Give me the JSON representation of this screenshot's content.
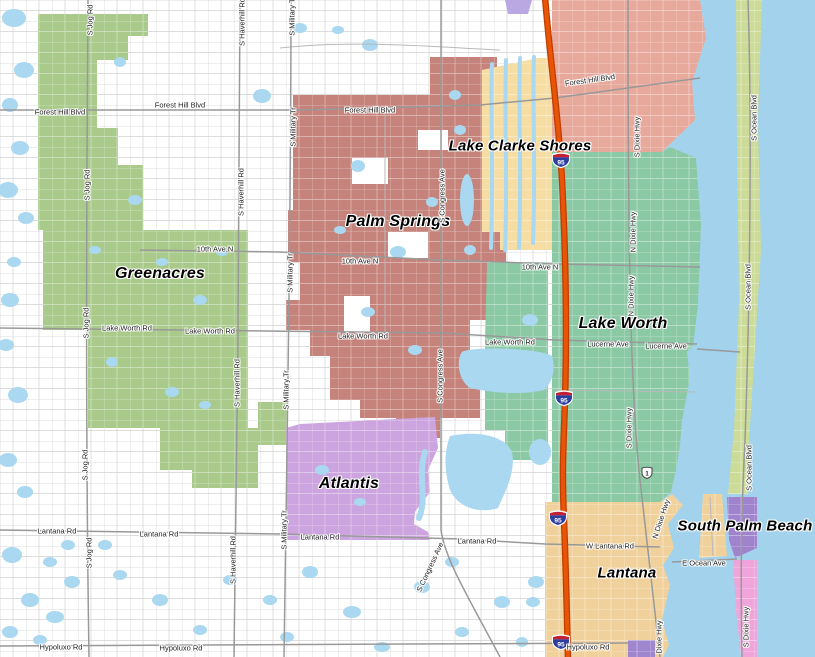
{
  "map": {
    "title": "Palm Beach County municipalities map",
    "regions": {
      "greenacres": {
        "name": "Greenacres",
        "color": "#a9ca8b"
      },
      "palm_springs": {
        "name": "Palm Springs",
        "color": "#c5837b"
      },
      "lake_clarke_shores": {
        "name": "Lake Clarke Shores",
        "color": "#f6dda4"
      },
      "north_pink_area": {
        "color": "#e7a99c"
      },
      "lake_worth": {
        "name": "Lake Worth",
        "color": "#8bc9a5"
      },
      "atlantis": {
        "name": "Atlantis",
        "color": "#cca4df"
      },
      "lantana": {
        "name": "Lantana",
        "color": "#f0d19c"
      },
      "south_palm_beach": {
        "name": "South Palm Beach",
        "color": "#a083cd"
      },
      "barrier_island": {
        "color": "#ccdb97"
      },
      "south_pink_area": {
        "color": "#f0a5da"
      },
      "south_purple_area": {
        "color": "#9f86cf"
      },
      "top_purple_area": {
        "color": "#b9a8e2"
      }
    },
    "water": {
      "ocean_color": "#a2d2ec",
      "pond_color": "#a9d8f0"
    },
    "roads": {
      "major_color": "#999999",
      "minor_color": "#b9b9b9",
      "interstate_color": "#e85507"
    },
    "city_labels": [
      {
        "text": "Lake Clarke Shores",
        "x": 520,
        "y": 146,
        "size": 15
      },
      {
        "text": "Palm Springs",
        "x": 398,
        "y": 222,
        "size": 16
      },
      {
        "text": "Greenacres",
        "x": 160,
        "y": 274,
        "size": 16
      },
      {
        "text": "Lake Worth",
        "x": 623,
        "y": 324,
        "size": 16
      },
      {
        "text": "Atlantis",
        "x": 349,
        "y": 484,
        "size": 16
      },
      {
        "text": "South Palm Beach",
        "x": 745,
        "y": 526,
        "size": 15
      },
      {
        "text": "Lantana",
        "x": 627,
        "y": 573,
        "size": 15
      }
    ],
    "road_labels": [
      {
        "text": "Forest Hill Blvd",
        "x": 60,
        "y": 112,
        "angle": 0
      },
      {
        "text": "Forest Hill Blvd",
        "x": 180,
        "y": 105,
        "angle": 0
      },
      {
        "text": "Forest Hill Blvd",
        "x": 370,
        "y": 110,
        "angle": 0
      },
      {
        "text": "Forest Hill Blvd",
        "x": 590,
        "y": 80,
        "angle": -8
      },
      {
        "text": "10th Ave N",
        "x": 215,
        "y": 249,
        "angle": 0
      },
      {
        "text": "10th Ave N",
        "x": 360,
        "y": 261,
        "angle": 0
      },
      {
        "text": "10th Ave N",
        "x": 540,
        "y": 267,
        "angle": 0
      },
      {
        "text": "Lake Worth Rd",
        "x": 127,
        "y": 328,
        "angle": 0
      },
      {
        "text": "Lake Worth Rd",
        "x": 210,
        "y": 331,
        "angle": 0
      },
      {
        "text": "Lake Worth Rd",
        "x": 363,
        "y": 336,
        "angle": 0
      },
      {
        "text": "Lake Worth Rd",
        "x": 510,
        "y": 342,
        "angle": 0
      },
      {
        "text": "Lucerne Ave",
        "x": 608,
        "y": 344,
        "angle": 0
      },
      {
        "text": "Lucerne Ave",
        "x": 666,
        "y": 346,
        "angle": 0
      },
      {
        "text": "Lantana Rd",
        "x": 57,
        "y": 531,
        "angle": 0
      },
      {
        "text": "Lantana Rd",
        "x": 159,
        "y": 534,
        "angle": 0
      },
      {
        "text": "Lantana Rd",
        "x": 320,
        "y": 537,
        "angle": 0
      },
      {
        "text": "Lantana Rd",
        "x": 477,
        "y": 541,
        "angle": 0
      },
      {
        "text": "W Lantana Rd",
        "x": 610,
        "y": 546,
        "angle": 0
      },
      {
        "text": "E Ocean Ave",
        "x": 704,
        "y": 563,
        "angle": 0
      },
      {
        "text": "Hypoluxo Rd",
        "x": 61,
        "y": 647,
        "angle": 0
      },
      {
        "text": "Hypoluxo Rd",
        "x": 181,
        "y": 648,
        "angle": 0
      },
      {
        "text": "Hypoluxo Rd",
        "x": 588,
        "y": 647,
        "angle": 0
      },
      {
        "text": "S Jog Rd",
        "x": 90,
        "y": 20,
        "angle": -90
      },
      {
        "text": "S Jog Rd",
        "x": 87,
        "y": 185,
        "angle": -90
      },
      {
        "text": "S Jog Rd",
        "x": 86,
        "y": 323,
        "angle": -90
      },
      {
        "text": "S Jog Rd",
        "x": 85,
        "y": 465,
        "angle": -90
      },
      {
        "text": "S Jog Rd",
        "x": 89,
        "y": 553,
        "angle": -90
      },
      {
        "text": "S Haverhill Rd",
        "x": 242,
        "y": 22,
        "angle": -90
      },
      {
        "text": "S Haverhill Rd",
        "x": 241,
        "y": 192,
        "angle": -90
      },
      {
        "text": "S Haverhill Rd",
        "x": 237,
        "y": 383,
        "angle": -90
      },
      {
        "text": "S Haverhill Rd",
        "x": 233,
        "y": 560,
        "angle": -90
      },
      {
        "text": "S Military Tr",
        "x": 292,
        "y": 16,
        "angle": -90
      },
      {
        "text": "S Military Tr",
        "x": 293,
        "y": 127,
        "angle": -90
      },
      {
        "text": "S Military Tr",
        "x": 290,
        "y": 273,
        "angle": -90
      },
      {
        "text": "S Military Tr",
        "x": 286,
        "y": 390,
        "angle": -90
      },
      {
        "text": "S Military Tr",
        "x": 284,
        "y": 530,
        "angle": -90
      },
      {
        "text": "S Congress Ave",
        "x": 442,
        "y": 196,
        "angle": -90
      },
      {
        "text": "S Congress Ave",
        "x": 440,
        "y": 376,
        "angle": -90
      },
      {
        "text": "S Congress Ave",
        "x": 430,
        "y": 567,
        "angle": -65
      },
      {
        "text": "S Dixie Hwy",
        "x": 637,
        "y": 137,
        "angle": -90
      },
      {
        "text": "N Dixie Hwy",
        "x": 633,
        "y": 232,
        "angle": -90
      },
      {
        "text": "N Dixie Hwy",
        "x": 631,
        "y": 296,
        "angle": -90
      },
      {
        "text": "S Dixie Hwy",
        "x": 629,
        "y": 428,
        "angle": -90
      },
      {
        "text": "N Dixie Hwy",
        "x": 661,
        "y": 519,
        "angle": -72
      },
      {
        "text": "Dixie Hwy",
        "x": 659,
        "y": 637,
        "angle": -90
      },
      {
        "text": "S Dixie Hwy",
        "x": 746,
        "y": 627,
        "angle": -90
      },
      {
        "text": "S Ocean Blvd",
        "x": 754,
        "y": 118,
        "angle": -90
      },
      {
        "text": "S Ocean Blvd",
        "x": 748,
        "y": 287,
        "angle": -90
      },
      {
        "text": "S Ocean Blvd",
        "x": 749,
        "y": 468,
        "angle": -90
      }
    ],
    "highways": {
      "interstate": {
        "number": "95"
      },
      "us_route": {
        "number": "1"
      },
      "shields": [
        {
          "x": 561,
          "y": 160,
          "type": "i95"
        },
        {
          "x": 564,
          "y": 398,
          "type": "i95"
        },
        {
          "x": 558,
          "y": 518,
          "type": "i95"
        },
        {
          "x": 561,
          "y": 642,
          "type": "i95"
        },
        {
          "x": 647,
          "y": 473,
          "type": "us1"
        }
      ]
    }
  }
}
